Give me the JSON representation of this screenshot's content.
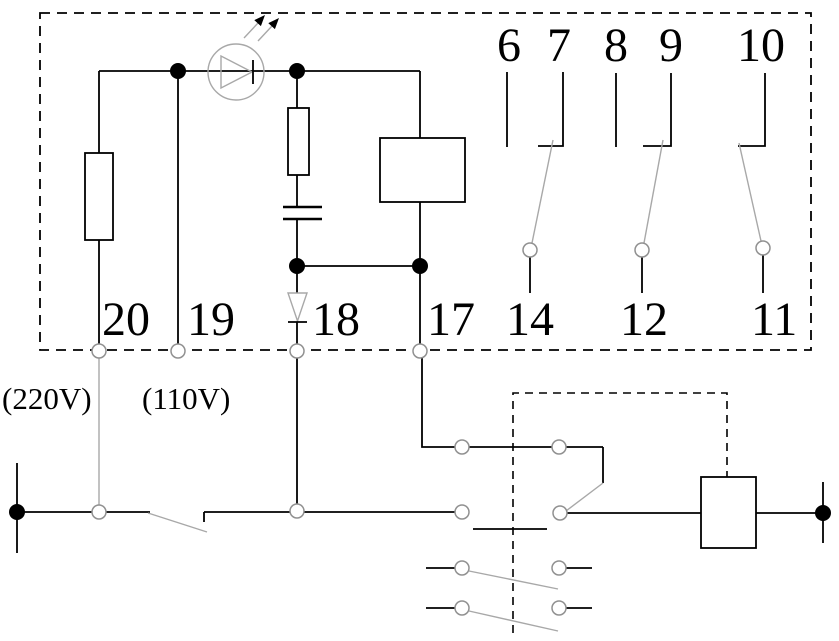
{
  "colors": {
    "wire": "#000000",
    "accent_gray": "#a8a8a8",
    "background": "#ffffff"
  },
  "labels": {
    "top_terminals": [
      "6",
      "7",
      "8",
      "9",
      "10"
    ],
    "mid_terminals": [
      "14",
      "12",
      "11"
    ],
    "bottom_terminals": [
      "20",
      "19",
      "18",
      "17"
    ],
    "voltages": [
      "(220V)",
      "(110V)"
    ]
  }
}
